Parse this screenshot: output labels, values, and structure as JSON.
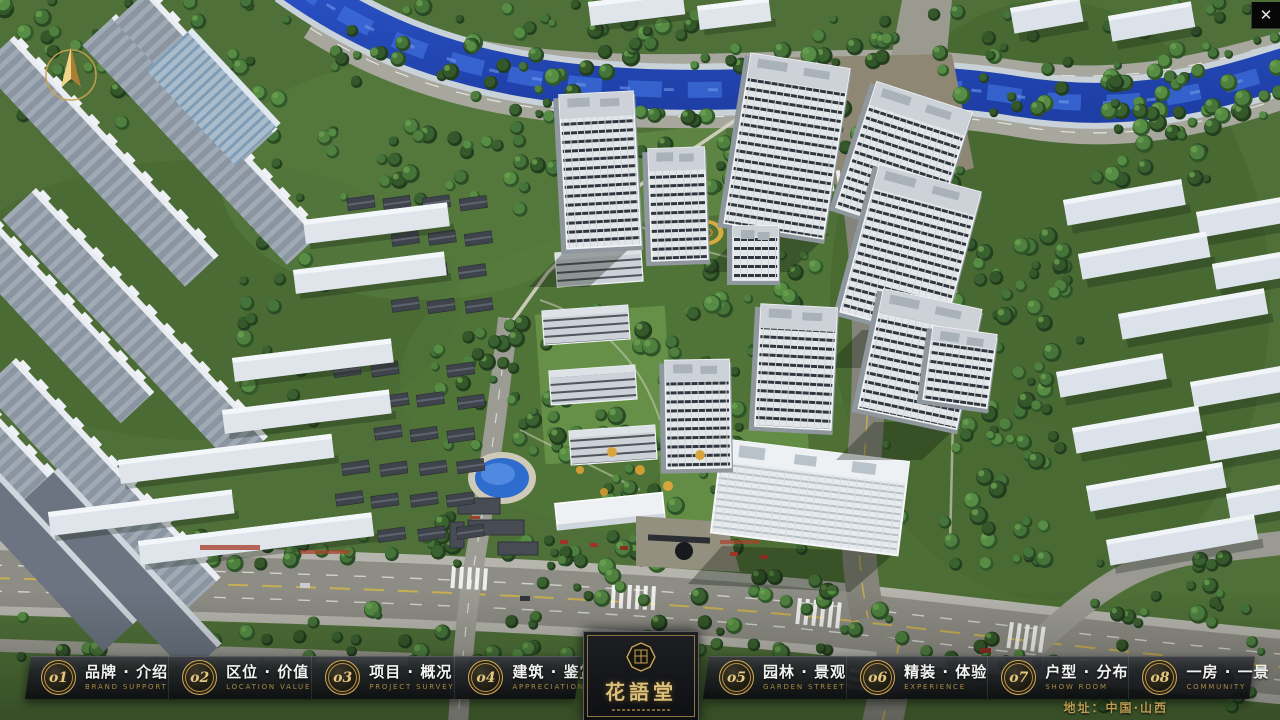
{
  "app": {
    "close_label": "✕"
  },
  "nav": {
    "items": [
      {
        "num": "o1",
        "zh": "品牌 · 介绍",
        "en": "BRAND SUPPORT"
      },
      {
        "num": "o2",
        "zh": "区位 · 价值",
        "en": "LOCATION VALUE"
      },
      {
        "num": "o3",
        "zh": "项目 · 概况",
        "en": "PROJECT SURVEY"
      },
      {
        "num": "o4",
        "zh": "建筑 · 鉴赏",
        "en": "APPRECIATION"
      },
      {
        "num": "o5",
        "zh": "园林 · 景观",
        "en": "GARDEN STREET"
      },
      {
        "num": "o6",
        "zh": "精装 · 体验",
        "en": "EXPERIENCE"
      },
      {
        "num": "o7",
        "zh": "户型 · 分布",
        "en": "SHOW ROOM"
      },
      {
        "num": "o8",
        "zh": "一房 · 一景",
        "en": "COMMUNITY"
      }
    ]
  },
  "logo": {
    "title": "花語堂"
  },
  "footer": {
    "address": "地址：中国·山西"
  },
  "colors": {
    "gold": "#c9a45c",
    "water": "#2c55cb",
    "panel": "#121316"
  }
}
